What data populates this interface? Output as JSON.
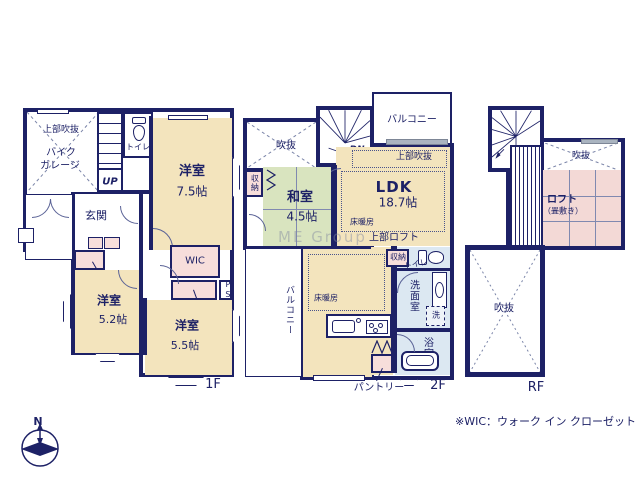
{
  "note": "※WIC：ウォーク イン クローゼット",
  "watermark": "ME Group",
  "compass": {
    "north": "N"
  },
  "colors": {
    "wall": "#1d2166",
    "room_cream": "#f3e4bd",
    "tatami_green": "#d9e4bf",
    "closet_pink": "#f7dedb",
    "loft_pink": "#f3d9d6",
    "sanitary_blue": "#dce8f2"
  },
  "f1": {
    "floor_label": "1F",
    "upper_void": "上部吹抜",
    "bike_garage_line1": "バイク",
    "bike_garage_line2": "ガレージ",
    "stairs_up": "UP",
    "toilet": "トイレ",
    "room75_name": "洋室",
    "room75_size": "7.5帖",
    "genkan": "玄関",
    "closet_a": "クローゼット",
    "room52_name": "洋室",
    "room52_size": "5.2帖",
    "wic": "WIC",
    "closet_b": "クローゼット",
    "ps": "PS",
    "room55_name": "洋室",
    "room55_size": "5.5帖"
  },
  "f2": {
    "floor_label": "2F",
    "void": "吹抜",
    "stairs_dn": "DN",
    "stairs_up": "UP",
    "balcony_top": "バルコニー",
    "upper_void": "上部吹抜",
    "ldk_name": "LDK",
    "ldk_size": "18.7帖",
    "storage_left": "収納",
    "washitsu_name": "和室",
    "washitsu_size": "4.5帖",
    "floor_heating_ldk": "床暖房",
    "upper_loft": "上部ロフト",
    "balcony_left": "バルコニー",
    "floor_heating_dining": "床暖房",
    "pantry": "パントリー",
    "storage_right": "収納",
    "toilet": "トイレ",
    "washroom": "洗面室",
    "washer": "洗",
    "bathroom": "浴室"
  },
  "rf": {
    "floor_label": "RF",
    "stairs_dn": "DN",
    "void_top": "吹抜",
    "loft_name": "ロフト",
    "loft_sub": "（畳敷き）",
    "void_big": "吹抜"
  }
}
